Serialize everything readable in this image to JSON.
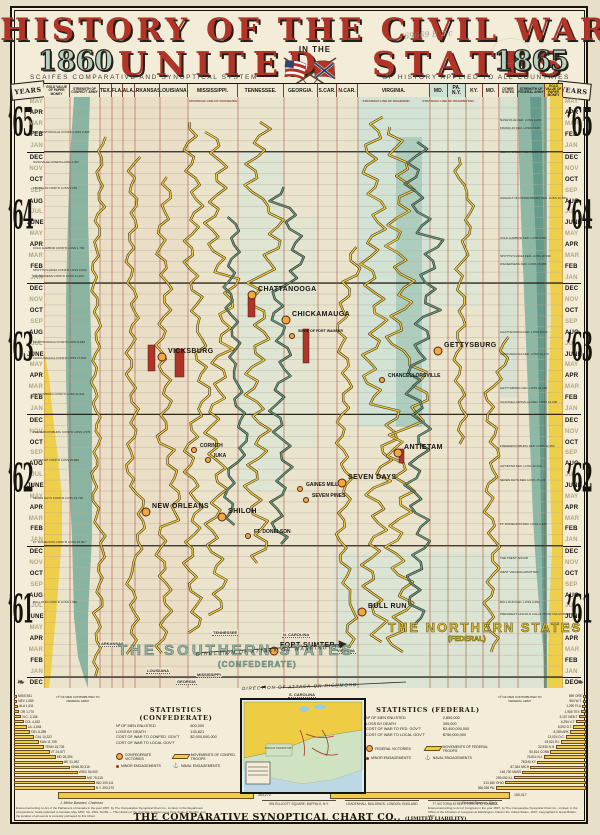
{
  "title": {
    "line1": "HISTORY OF THE CIVIL WAR",
    "word_left": "UNITED",
    "word_right": "STATES",
    "in_the": "IN THE",
    "year_left": "1860",
    "year_right": "1865",
    "subtitle_left": "SCAIFES COMPARATIVE AND SYNOPTICAL SYSTEM",
    "subtitle_right": "OF HISTORY APPLIED TO ALL COUNTRIES",
    "handwriting": "69669 B 2-c"
  },
  "header": {
    "years_label": "YEARS",
    "columns": [
      {
        "label": "GOLD VALUE OF PAPER MONEY",
        "x0": 44,
        "x1": 70,
        "cls": "ch-t",
        "tint": ""
      },
      {
        "label": "STRENGTH OF CONFED’T ARMY",
        "x0": 70,
        "x1": 100,
        "cls": "ch-t",
        "tint": ""
      },
      {
        "label": "TEX.",
        "x0": 100,
        "x1": 112,
        "cls": "ch-s",
        "tint": ""
      },
      {
        "label": "FLA.",
        "x0": 112,
        "x1": 123,
        "cls": "ch-s",
        "tint": ""
      },
      {
        "label": "ALA.",
        "x0": 123,
        "x1": 135,
        "cls": "ch-s",
        "tint": ""
      },
      {
        "label": "ARKANSAS.",
        "x0": 135,
        "x1": 160,
        "cls": "ch-s",
        "tint": ""
      },
      {
        "label": "LOUISIANA.",
        "x0": 160,
        "x1": 188,
        "cls": "ch-s",
        "tint": ""
      },
      {
        "label": "MISSISSIPPI.",
        "x0": 188,
        "x1": 238,
        "cls": "ch-s",
        "tint": ""
      },
      {
        "label": "TENNESSEE.",
        "x0": 238,
        "x1": 284,
        "cls": "ch-s",
        "tint": ""
      },
      {
        "label": "GEORGIA.",
        "x0": 284,
        "x1": 318,
        "cls": "ch-s",
        "tint": ""
      },
      {
        "label": "S.CAR.",
        "x0": 318,
        "x1": 337,
        "cls": "ch-s",
        "tint": ""
      },
      {
        "label": "N.CAR.",
        "x0": 337,
        "x1": 358,
        "cls": "ch-s",
        "tint": ""
      },
      {
        "label": "VIRGINIA.",
        "x0": 358,
        "x1": 430,
        "cls": "ch-s",
        "tint": ""
      },
      {
        "label": "MD.",
        "x0": 430,
        "x1": 448,
        "cls": "ch-s",
        "tint": "tint-pale"
      },
      {
        "label": "PA. N.Y.",
        "x0": 448,
        "x1": 466,
        "cls": "ch-s",
        "tint": "tint-pale"
      },
      {
        "label": "KY.",
        "x0": 466,
        "x1": 483,
        "cls": "ch-s",
        "tint": ""
      },
      {
        "label": "MO.",
        "x0": 483,
        "x1": 499,
        "cls": "ch-s",
        "tint": ""
      },
      {
        "label": "OTHER STATES",
        "x0": 499,
        "x1": 518,
        "cls": "ch-t",
        "tint": ""
      },
      {
        "label": "STRENGTH OF FEDERAL ARMY",
        "x0": 518,
        "x1": 545,
        "cls": "ch-t",
        "tint": "tint-teal"
      },
      {
        "label": "GOLD VALUE OF PAPER MONEY",
        "x0": 545,
        "x1": 563,
        "cls": "ch-t",
        "tint": "tint-gold"
      }
    ]
  },
  "timeline": {
    "blocks": [
      {
        "year": "’65",
        "startDark": false,
        "months": [
          "MAY",
          "APR",
          "MAR",
          "FEB",
          "JAN"
        ]
      },
      {
        "year": "’64",
        "startDark": true,
        "months": [
          "DEC",
          "NOV",
          "OCT",
          "SEP",
          "AUG",
          "JUL",
          "JUNE",
          "MAY",
          "APR",
          "MAR",
          "FEB",
          "JAN"
        ]
      },
      {
        "year": "’63",
        "startDark": true,
        "months": [
          "DEC",
          "NOV",
          "OCT",
          "SEP",
          "AUG",
          "JUL",
          "JUNE",
          "MAY",
          "APR",
          "MAR",
          "FEB",
          "JAN"
        ]
      },
      {
        "year": "’62",
        "startDark": true,
        "months": [
          "DEC",
          "NOV",
          "OCT",
          "SEP",
          "AUG",
          "JUL",
          "JUNE",
          "MAY",
          "APR",
          "MAR",
          "FEB",
          "JAN"
        ]
      },
      {
        "year": "’61",
        "startDark": true,
        "months": [
          "DEC",
          "NOV",
          "OCT",
          "SEP",
          "AUG",
          "JUL",
          "JUNE",
          "MAY",
          "APR",
          "MAR",
          "FEB",
          "JAN"
        ]
      },
      {
        "year": "",
        "startDark": true,
        "months": [
          "DEC"
        ]
      }
    ]
  },
  "battles": [
    {
      "n": "CORINTH",
      "x": 200,
      "y": 446,
      "s": "m"
    },
    {
      "n": "IUKA",
      "x": 214,
      "y": 456,
      "s": "m"
    },
    {
      "n": "CHATTANOOGA",
      "x": 258,
      "y": 291,
      "s": "b"
    },
    {
      "n": "CHICKAMAUGA",
      "x": 292,
      "y": 316,
      "s": "b"
    },
    {
      "n": "VICKSBURG",
      "x": 168,
      "y": 353,
      "s": "b"
    },
    {
      "n": "SIEGE OF FORT WAGNER",
      "x": 298,
      "y": 332,
      "s": "s"
    },
    {
      "n": "GETTYSBURG",
      "x": 444,
      "y": 347,
      "s": "b"
    },
    {
      "n": "CHANCELLORSVILLE",
      "x": 388,
      "y": 376,
      "s": "m"
    },
    {
      "n": "ANTIETAM",
      "x": 404,
      "y": 449,
      "s": "b"
    },
    {
      "n": "SEVEN DAYS",
      "x": 348,
      "y": 479,
      "s": "b"
    },
    {
      "n": "GAINES MILL",
      "x": 306,
      "y": 485,
      "s": "m"
    },
    {
      "n": "SEVEN PINES",
      "x": 312,
      "y": 496,
      "s": "m"
    },
    {
      "n": "NEW ORLEANS",
      "x": 152,
      "y": 508,
      "s": "b"
    },
    {
      "n": "SHILOH",
      "x": 228,
      "y": 513,
      "s": "b"
    },
    {
      "n": "FT. DONELSON",
      "x": 254,
      "y": 532,
      "s": "m"
    },
    {
      "n": "BULL RUN",
      "x": 368,
      "y": 608,
      "s": "b"
    },
    {
      "n": "FORT SUMTER",
      "x": 280,
      "y": 647,
      "s": "b"
    }
  ],
  "strategic_labels": [
    {
      "t": "STRATEGIC LINE OF VICKSBURG",
      "x": 183,
      "y": 99
    },
    {
      "t": "STRATEGIC LINE OF RICHMOND",
      "x": 356,
      "y": 99
    },
    {
      "t": "STRATEGIC LINE OF WASHINGTON",
      "x": 418,
      "y": 99
    }
  ],
  "secession_labels": [
    {
      "t": "ARKANSAS",
      "x": 100,
      "y": 641
    },
    {
      "t": "TENNESSEE",
      "x": 212,
      "y": 630
    },
    {
      "t": "LOUISIANA",
      "x": 146,
      "y": 668
    },
    {
      "t": "MISSISSIPPI",
      "x": 196,
      "y": 672
    },
    {
      "t": "GEORGIA",
      "x": 176,
      "y": 679
    },
    {
      "t": "S. CAROLINA",
      "x": 288,
      "y": 692
    },
    {
      "t": "N. CAROLINA",
      "x": 282,
      "y": 632
    },
    {
      "t": "VIRGINIA",
      "x": 336,
      "y": 648
    }
  ],
  "annotations_left": [
    {
      "y": 130,
      "t": "$60. BENTONVILLE CONF’D LOSS 2,825"
    },
    {
      "y": 160,
      "t": "NASHVILLE CONF’D LOSS 4,462"
    },
    {
      "y": 186,
      "t": "FRANKLIN CONF’D LOSS 6,252"
    },
    {
      "y": 246,
      "t": "COLD HARBOR CONF’D LOSS 1,700"
    },
    {
      "y": 268,
      "t": "SPOTTSYLVANIA CONF’D LOSS 9,000"
    },
    {
      "y": 274,
      "t": "WILDERNESS CONF’D LOSS 11,400"
    },
    {
      "y": 340,
      "t": "CHATTANOOGA CONF’D LOSS 8,684"
    },
    {
      "y": 356,
      "t": "CHICKAMAUGA CONF’D LOSS 17,804"
    },
    {
      "y": 392,
      "t": "GETTYSBURG CONF’D LOSS 31,621"
    },
    {
      "y": 430,
      "t": "FREDERICKSBURG CONF’D LOSS 4,576"
    },
    {
      "y": 458,
      "t": "ANTIETAM CONF’D LOSS 25,899"
    },
    {
      "y": 496,
      "t": "SEVEN DAYS CONF’D LOSS 19,739"
    },
    {
      "y": 540,
      "t": "FT. DONELSON CONF’D LOSS 15,067"
    },
    {
      "y": 600,
      "t": "BULL RUN CONF’D LOSS 1,982"
    }
  ],
  "annotations_right": [
    {
      "y": 118,
      "t": "NASHVILLE FED. LOSS 3,057"
    },
    {
      "y": 126,
      "t": "FRANKLIN FED. LOSS 2,326"
    },
    {
      "y": 150,
      "t": "CEDAR CREEK FED. LOSS 5,995"
    },
    {
      "y": 196,
      "t": "ASSAULT ON PETERSBURG FED. LOSS 10,586"
    },
    {
      "y": 236,
      "t": "COLD HARBOR FED. LOSS 9,457"
    },
    {
      "y": 254,
      "t": "SPOTTSYLVANIA FED. LOSS 18,399"
    },
    {
      "y": 262,
      "t": "WILDERNESS FED. LOSS 15,384"
    },
    {
      "y": 330,
      "t": "CHATTANOOGA FED. LOSS 5,616"
    },
    {
      "y": 352,
      "t": "CHICKAMAUGA FED. LOSS 16,179"
    },
    {
      "y": 386,
      "t": "GETTYSBURG FED. LOSS 23,186"
    },
    {
      "y": 400,
      "t": "CHANCELLORSVILLE FED. LOSS 16,030"
    },
    {
      "y": 444,
      "t": "FREDERICKSBURG FED. LOSS 12,353"
    },
    {
      "y": 464,
      "t": "ANTIETAM FED. LOSS 12,410"
    },
    {
      "y": 478,
      "t": "SEVEN DAYS FED. LOSS 15,249"
    },
    {
      "y": 522,
      "t": "FT. DONELSON FED. LOSS 2,886"
    },
    {
      "y": 556,
      "t": "THE TRENT AFFAIR"
    },
    {
      "y": 570,
      "t": "WEST VIRGINIA ADMITTED"
    },
    {
      "y": 600,
      "t": "BULL RUN FED. LOSS 2,952"
    },
    {
      "y": 612,
      "t": "PRESIDENT LINCOLN CALLS 75,000 VOLUNTEERS"
    }
  ],
  "regions": {
    "southern": "THE SOUTHERN STATES",
    "southern_sub": "(CONFEDERATE)",
    "northern": "THE NORTHERN STATES",
    "northern_sub": "(FEDERAL)",
    "attack_washington": "DIRECTION OF ATTACK ON WASHINGTON",
    "attack_richmond": "DIRECTION OF ATTACK ON RICHMOND"
  },
  "movement_lines": [
    {
      "x": 52,
      "y0": 40,
      "y1": 580,
      "amp": 3,
      "seed": 1,
      "c": "y"
    },
    {
      "x": 88,
      "y0": 60,
      "y1": 560,
      "amp": 4,
      "seed": 2,
      "c": "y"
    },
    {
      "x": 120,
      "y0": 80,
      "y1": 560,
      "amp": 5,
      "seed": 3,
      "c": "y"
    },
    {
      "x": 149,
      "y0": 25,
      "y1": 540,
      "amp": 6,
      "seed": 4,
      "c": "y"
    },
    {
      "x": 172,
      "y0": 35,
      "y1": 520,
      "amp": 7,
      "seed": 5,
      "c": "y"
    },
    {
      "x": 188,
      "y0": 120,
      "y1": 430,
      "amp": 5,
      "seed": 11,
      "c": "g"
    },
    {
      "x": 213,
      "y0": 25,
      "y1": 470,
      "amp": 8,
      "seed": 6,
      "c": "y"
    },
    {
      "x": 237,
      "y0": 90,
      "y1": 450,
      "amp": 7,
      "seed": 7,
      "c": "g"
    },
    {
      "x": 300,
      "y0": 150,
      "y1": 560,
      "amp": 5,
      "seed": 8,
      "c": "y"
    },
    {
      "x": 330,
      "y0": 20,
      "y1": 545,
      "amp": 8,
      "seed": 9,
      "c": "y"
    },
    {
      "x": 356,
      "y0": 30,
      "y1": 555,
      "amp": 9,
      "seed": 10,
      "c": "y"
    },
    {
      "x": 374,
      "y0": 45,
      "y1": 530,
      "amp": 8,
      "seed": 12,
      "c": "g"
    },
    {
      "x": 416,
      "y0": 60,
      "y1": 350,
      "amp": 4,
      "seed": 13,
      "c": "y"
    },
    {
      "x": 448,
      "y0": 240,
      "y1": 560,
      "amp": 5,
      "seed": 14,
      "c": "y"
    }
  ],
  "siege_bars": [
    {
      "x": 104,
      "y": 248,
      "w": 7,
      "h": 26
    },
    {
      "x": 131,
      "y": 252,
      "w": 9,
      "h": 28
    },
    {
      "x": 259,
      "y": 232,
      "w": 6,
      "h": 34
    },
    {
      "x": 204,
      "y": 200,
      "w": 7,
      "h": 20
    },
    {
      "x": 355,
      "y": 352,
      "w": 5,
      "h": 14
    }
  ],
  "stats_confederate": {
    "title": "STATISTICS (CONFEDERATE)",
    "lines": [
      [
        "Nº OF MEN ENLISTED",
        "600,000"
      ],
      [
        "LOSS BY DEATH",
        "133,821"
      ],
      [
        "COST OF WAR TO CONFED. GOV’T",
        "$2,000,000,000"
      ],
      [
        "COST OF WAR TO LOCAL GOV’T",
        ""
      ]
    ],
    "legend": [
      {
        "ic": "vic",
        "t": "CONFEDERATE VICTORIES"
      },
      {
        "ic": "tr",
        "t": "MOVEMENTS OF CONFED. TROOPS"
      },
      {
        "ic": "min",
        "t": "MINOR ENGAGEMENTS"
      },
      {
        "ic": "nav",
        "t": "NAVAL ENGAGEMENTS"
      }
    ]
  },
  "stats_federal": {
    "title": "STATISTICS (FEDERAL)",
    "lines": [
      [
        "Nº OF MEN ENLISTED",
        "2,850,000"
      ],
      [
        "LOSS BY DEATH",
        "305,000"
      ],
      [
        "COST OF WAR TO FED. GOV’T",
        "$3,400,000,000"
      ],
      [
        "COST OF WAR TO LOCAL GOV’T",
        "$750,000,000"
      ]
    ],
    "legend": [
      {
        "ic": "vic",
        "t": "FEDERAL VICTORIES"
      },
      {
        "ic": "tr",
        "t": "MOVEMENTS OF FEDERAL TROOPS"
      },
      {
        "ic": "min",
        "t": "MINOR ENGAGEMENTS"
      },
      {
        "ic": "nav",
        "t": "NAVAL ENGAGEMENTS"
      }
    ]
  },
  "stairs_left": {
    "title": "Nº OF MEN CONTRIBUTED TO FEDERAL ARMY",
    "items": [
      {
        "label": "MISS",
        "value": "651"
      },
      {
        "label": "NEV",
        "value": "1,080"
      },
      {
        "label": "ALA",
        "value": "1,611"
      },
      {
        "label": "OR",
        "value": "1,770"
      },
      {
        "label": "N.C.",
        "value": "3,156"
      },
      {
        "label": "COL",
        "value": "4,432"
      },
      {
        "label": "LA.",
        "value": "4,654"
      },
      {
        "label": "DEL",
        "value": "8,289"
      },
      {
        "label": "CAL",
        "value": "10,322"
      },
      {
        "label": "KAN",
        "value": "11,755"
      },
      {
        "label": "TENN",
        "value": "15,739"
      },
      {
        "label": "VT",
        "value": "24,577"
      },
      {
        "label": "MD",
        "value": "26,394"
      },
      {
        "label": "ME",
        "value": "31,092"
      },
      {
        "label": "IOWA",
        "value": "50,316"
      },
      {
        "label": "WISC",
        "value": "54,050"
      },
      {
        "label": "MO",
        "value": "75,315"
      },
      {
        "label": "IND",
        "value": "109,111"
      },
      {
        "label": "N.Y.",
        "value": "393,270"
      }
    ]
  },
  "stairs_right": {
    "title": "Nº OF MEN CONTRIBUTED TO FEDERAL ARMY",
    "items": [
      {
        "label": "ORE",
        "value": "899"
      },
      {
        "label": "W.T.",
        "value": "964"
      },
      {
        "label": "FLA",
        "value": "1,290"
      },
      {
        "label": "TEX",
        "value": "1,965"
      },
      {
        "label": "NEB.T",
        "value": "3,157"
      },
      {
        "label": "U.T.",
        "value": "4,294"
      },
      {
        "label": "D.T.",
        "value": "5,092"
      },
      {
        "label": "ARK",
        "value": "8,289"
      },
      {
        "label": "D.C.",
        "value": "13,024"
      },
      {
        "label": "R.I.",
        "value": "19,521"
      },
      {
        "label": "N.H.",
        "value": "32,930"
      },
      {
        "label": "CONN",
        "value": "50,514"
      },
      {
        "label": "N.J.",
        "value": "76,814"
      },
      {
        "label": "KY.",
        "value": "78,540"
      },
      {
        "label": "MICH",
        "value": "87,364"
      },
      {
        "label": "MASS",
        "value": "146,730"
      },
      {
        "label": "ILL",
        "value": "259,092"
      },
      {
        "label": "OHIO",
        "value": "313,180"
      },
      {
        "label": "PA.",
        "value": "366,326"
      }
    ]
  },
  "map": {
    "label_indian": "INDIAN TERRITORY"
  },
  "footer": {
    "bar1": "393,270",
    "bar2": "150,317",
    "sig_left": "J. Mellor Barward, Chairman",
    "sig_right": "Edward Pearson, Sec’y",
    "fineprint_left": "Entered according to Act of the Parliament of Canada in the year 1897, by The Comparative Synoptical Chart Co., Limited, in the Department of Agriculture. Scale patented in Canada, May 1897. No. 2391. NOTE — This History of the Civil War is shown on a Time Scale of Months, and the location of all events is correctly portrayed by this Chart.",
    "fineprint_right": "Entered according to Act of Congress in the year 1897, by The Comparative Synoptical Chart Co., Limited, in the Office of the Librarian of Congress at Washington. Filed in the United States, 1897. Copyrighted in Great Britain, 1897.",
    "addresses": [
      "691 ELLICOTT SQUARE, BUFFALO, N.Y.",
      "LEADENHALL BUILDINGS, LONDON, ENGLAND",
      "77 VICTORIA STREET, TORONTO, CANADA"
    ],
    "company": "THE COMPARATIVE SYNOPTICAL CHART CO.,",
    "company_small": "(LIMITED LIABILITY)"
  },
  "chart_data": [
    {
      "type": "table",
      "title": "Major engagements on time scale of months (1860–1865)",
      "columns": [
        "battle",
        "approx_position_year"
      ],
      "rows": [
        [
          "FORT SUMTER",
          "1861"
        ],
        [
          "BULL RUN",
          "1861"
        ],
        [
          "FT. DONELSON",
          "1862"
        ],
        [
          "SHILOH",
          "1862"
        ],
        [
          "NEW ORLEANS",
          "1862"
        ],
        [
          "SEVEN PINES",
          "1862"
        ],
        [
          "GAINES MILL",
          "1862"
        ],
        [
          "SEVEN DAYS",
          "1862"
        ],
        [
          "ANTIETAM",
          "1862"
        ],
        [
          "CORINTH",
          "1862"
        ],
        [
          "IUKA",
          "1862"
        ],
        [
          "CHANCELLORSVILLE",
          "1863"
        ],
        [
          "GETTYSBURG",
          "1863"
        ],
        [
          "VICKSBURG",
          "1863"
        ],
        [
          "SIEGE OF FORT WAGNER",
          "1863"
        ],
        [
          "CHICKAMAUGA",
          "1863"
        ],
        [
          "CHATTANOOGA",
          "1863"
        ]
      ]
    },
    {
      "type": "bar",
      "title": "No. of men contributed to Federal Army (left staircase)",
      "categories": [
        "MISS",
        "NEV",
        "ALA",
        "OR",
        "N.C.",
        "COL",
        "LA.",
        "DEL",
        "CAL",
        "KAN",
        "TENN",
        "VT",
        "MD",
        "ME",
        "IOWA",
        "WISC",
        "MO",
        "IND",
        "N.Y."
      ],
      "values": [
        651,
        1080,
        1611,
        1770,
        3156,
        4432,
        4654,
        8289,
        10322,
        11755,
        15739,
        24577,
        26394,
        31092,
        50316,
        54050,
        75315,
        109111,
        393270
      ],
      "xlabel": "state",
      "ylabel": "men enlisted"
    },
    {
      "type": "bar",
      "title": "No. of men contributed to Federal Army (right staircase)",
      "categories": [
        "ORE",
        "W.T.",
        "FLA",
        "TEX",
        "NEB.T",
        "U.T.",
        "D.T.",
        "ARK",
        "D.C.",
        "R.I.",
        "N.H.",
        "CONN",
        "N.J.",
        "KY.",
        "MICH",
        "MASS",
        "ILL",
        "OHIO",
        "PA."
      ],
      "values": [
        899,
        964,
        1290,
        1965,
        3157,
        4294,
        5092,
        8289,
        13024,
        19521,
        32930,
        50514,
        76814,
        78540,
        87364,
        146730,
        259092,
        313180,
        366326
      ],
      "xlabel": "state",
      "ylabel": "men enlisted"
    }
  ]
}
